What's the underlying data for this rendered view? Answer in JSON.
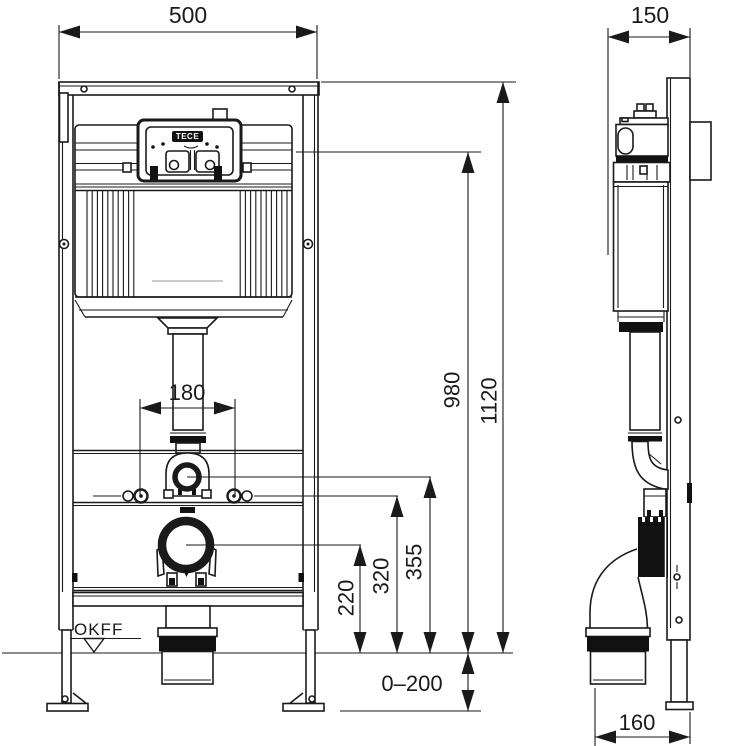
{
  "drawing": {
    "brand": "TECE",
    "floor_label": "OKFF",
    "dims": {
      "front_width": "500",
      "side_depth": "150",
      "total_height": "1120",
      "actuation_height": "980",
      "flush_bend_height": "355",
      "fixing_bolt_height": "320",
      "outlet_height": "220",
      "bolt_spacing": "180",
      "foot_adjust_range": "0–200",
      "outlet_offset": "160"
    },
    "colors": {
      "line": "#1a1a1a",
      "background": "#ffffff"
    }
  }
}
